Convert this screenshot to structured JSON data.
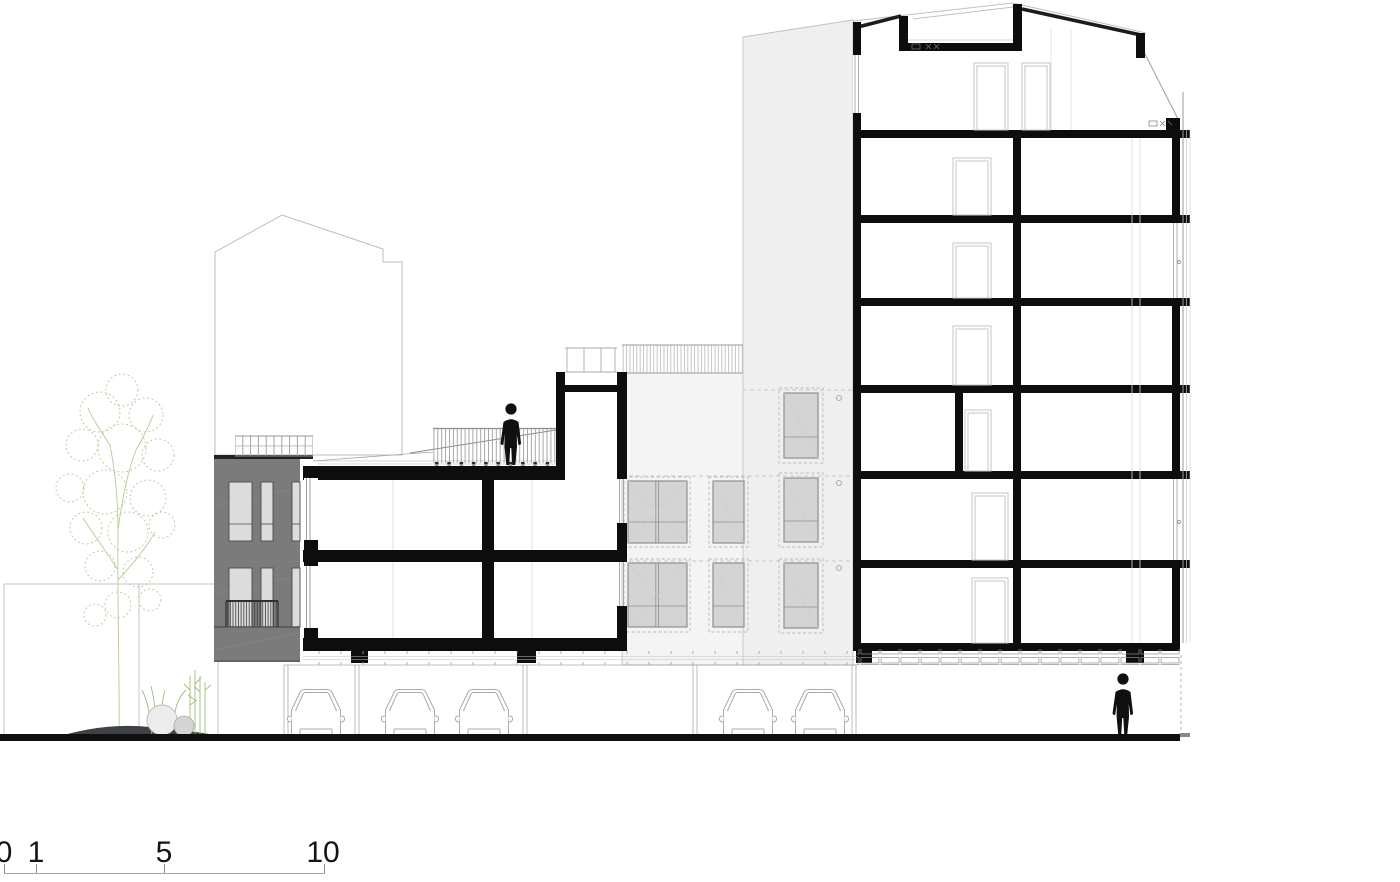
{
  "document": {
    "type": "architectural-section-elevation",
    "background_color": "#ffffff"
  },
  "scale_bar": {
    "labels": [
      "0",
      "1",
      "5",
      "10"
    ],
    "unit": "meters"
  },
  "drawing": {
    "poche_color": "#0d0d0d",
    "gray_facade_color": "#7b7b7b",
    "window_pane_color": "#d6d6d6",
    "light_facade_left_color": "#f4f4f4",
    "light_facade_right_color": "#efefef",
    "tree_color": "#b3cc96",
    "ground_mound_color": "#3e4145",
    "people_count": 2,
    "cars_count": 5,
    "trees_count": 1,
    "tall_block_storeys": 7,
    "left_block_storeys": 2,
    "gray_block_storeys": 2
  }
}
